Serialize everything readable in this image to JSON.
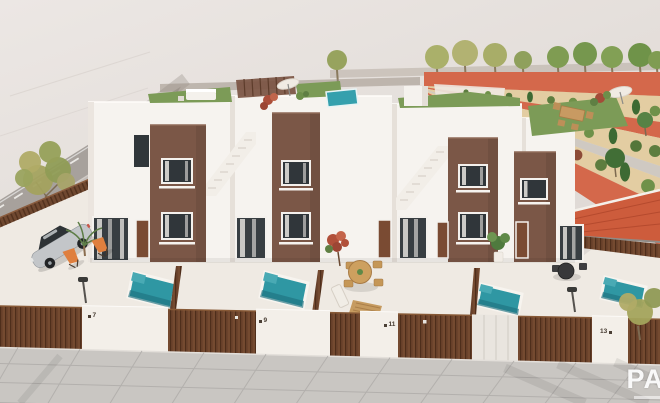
{
  "scene": {
    "description": "Aerial 3D architectural render of a row of four modern white and brown townhouses with roof terraces, private plunge pools, fenced front yards, a parked silver car, a street on the left and a landscaped boulevard with orange paths on the right",
    "watermark": "PA"
  },
  "houses": [
    {
      "number": "7"
    },
    {
      "number": "9"
    },
    {
      "number": "11"
    },
    {
      "number": "13"
    }
  ],
  "colors": {
    "wall_white": "#f6f3ef",
    "wall_brown": "#7b5747",
    "road_gray": "#a7a19c",
    "sidewalk_gray": "#c9c6c2",
    "yard_cream": "#efeae3",
    "pool_teal": "#2f97a3",
    "turf_green": "#7c9b57",
    "path_orange": "#d4684b",
    "sand": "#e3cda2",
    "roof_tile_red": "#cd5c3c",
    "fence_brown": "#6b432c",
    "car_silver": "#c3c6c9",
    "lounger_orange": "#df7f3e"
  }
}
